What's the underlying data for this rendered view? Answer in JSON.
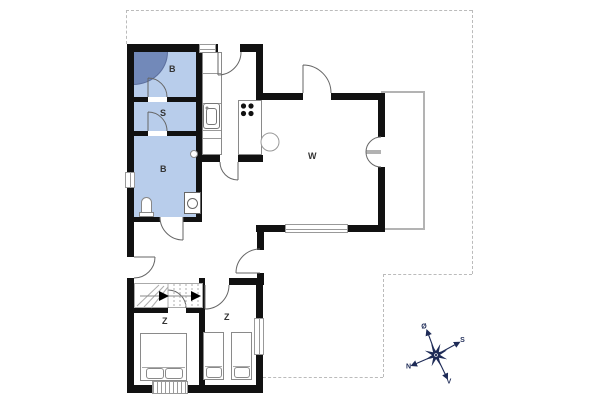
{
  "title": "Floor plan",
  "colors": {
    "wall": "#111111",
    "room_fill": "#b8cdeb",
    "shower_fill": "#7289b9",
    "fixture": "#8a8a8a",
    "compass": "#1e2b57",
    "dash": "#bbbbbb",
    "label": "#333333"
  },
  "rooms": [
    {
      "id": "bathroom-top",
      "label": "B"
    },
    {
      "id": "utility-room",
      "label": "S"
    },
    {
      "id": "bathroom-main",
      "label": "B"
    },
    {
      "id": "living-room",
      "label": "W"
    },
    {
      "id": "bedroom-left",
      "label": "Z"
    },
    {
      "id": "bedroom-right",
      "label": "Z"
    }
  ],
  "compass": {
    "north": "N",
    "south": "S",
    "east": "Ø",
    "west": "V"
  }
}
